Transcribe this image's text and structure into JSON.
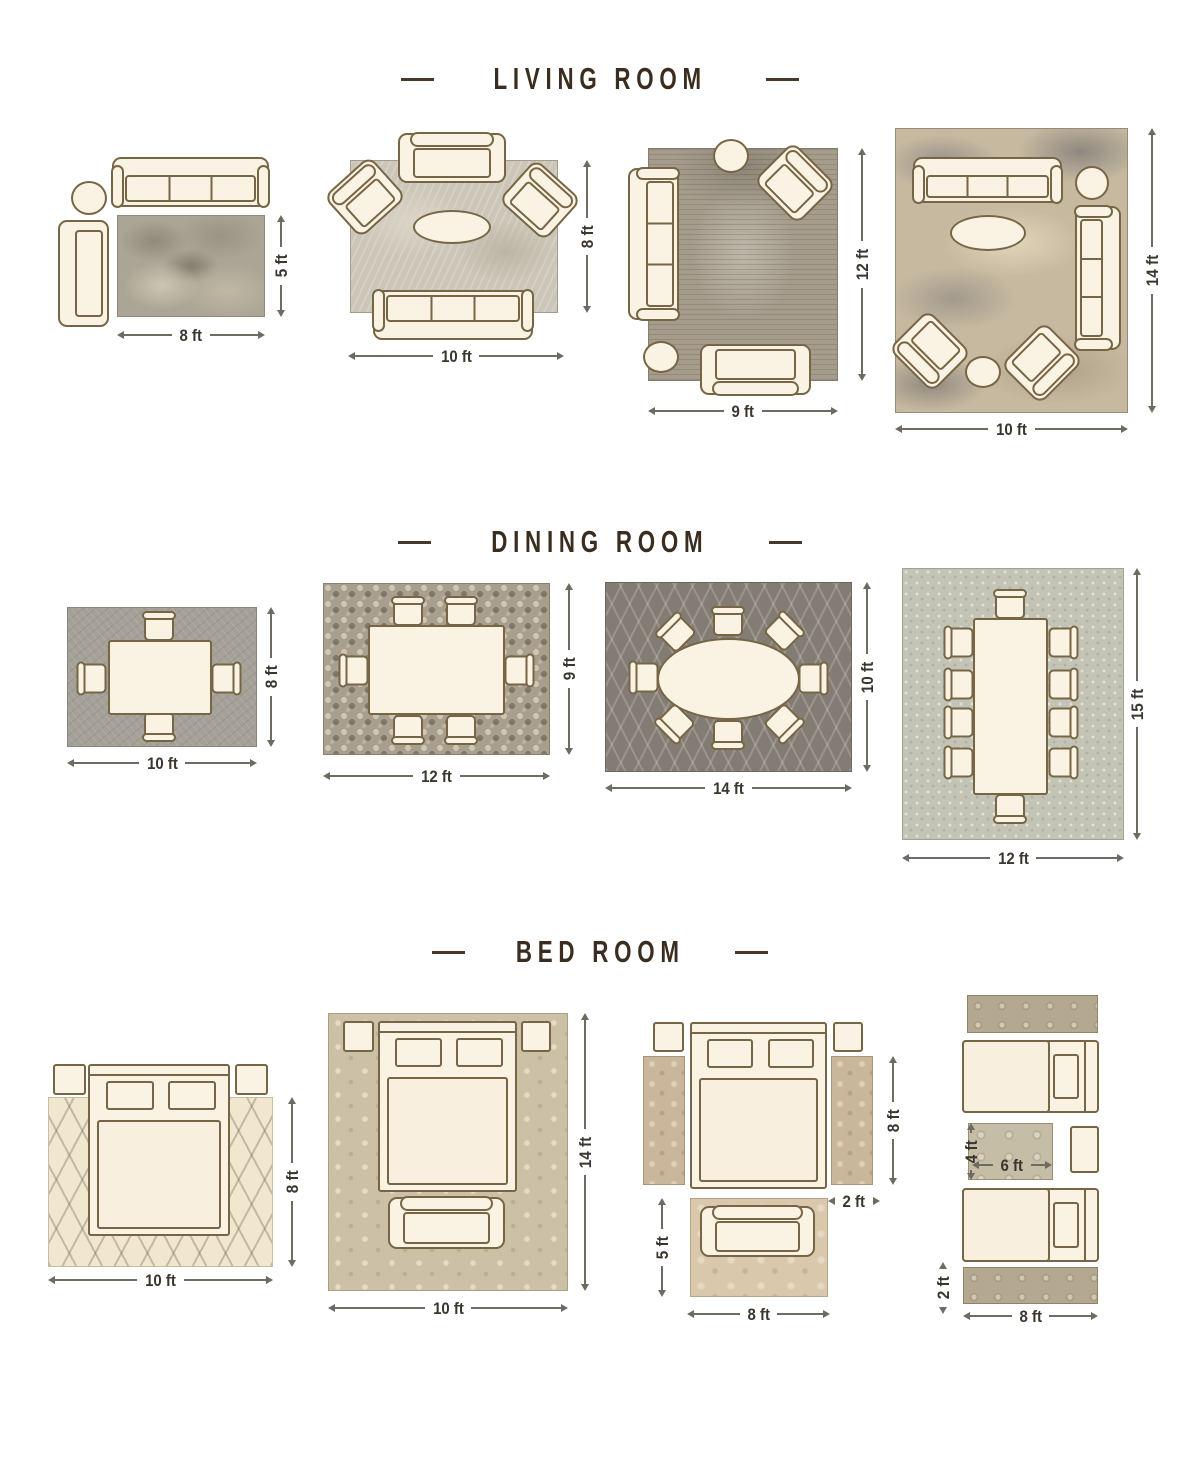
{
  "page": {
    "background": "#ffffff"
  },
  "colors": {
    "furniture_fill": "#faf2e3",
    "furniture_outline": "#776645",
    "title_text": "#3a2d1f",
    "title_dash": "#473829",
    "dimension_text": "#3a362e",
    "dimension_line": "#6f6b62"
  },
  "sections": [
    {
      "title": "LIVING ROOM",
      "layouts": [
        {
          "name": "living-rug-8x5",
          "rug_size": "8 ft x 5 ft",
          "furniture": [
            "sofa",
            "round-side-table",
            "chaise-sofa",
            "rug"
          ],
          "dims": {
            "bottom": "8 ft",
            "right": "5 ft"
          }
        },
        {
          "name": "living-rug-10x8",
          "rug_size": "10 ft x 8 ft",
          "furniture": [
            "loveseat",
            "armchair",
            "armchair",
            "oval-coffee-table",
            "sofa",
            "rug"
          ],
          "dims": {
            "bottom": "10 ft",
            "right": "8 ft"
          }
        },
        {
          "name": "living-rug-9x12",
          "rug_size": "9 ft x 12 ft",
          "furniture": [
            "round-side-table",
            "armchair",
            "sofa",
            "round-side-table",
            "loveseat",
            "rug"
          ],
          "dims": {
            "bottom": "9 ft",
            "right": "12 ft"
          }
        },
        {
          "name": "living-rug-10x14",
          "rug_size": "10 ft x 14 ft",
          "furniture": [
            "sofa",
            "round-side-table",
            "sofa",
            "oval-coffee-table",
            "armchair",
            "armchair",
            "round-side-table",
            "rug"
          ],
          "dims": {
            "bottom": "10 ft",
            "right": "14 ft"
          }
        }
      ]
    },
    {
      "title": "DINING ROOM",
      "layouts": [
        {
          "name": "dining-rug-10x8",
          "rug_size": "10 ft x 8 ft",
          "furniture": [
            "dining-table",
            "4 dining-chairs",
            "rug"
          ],
          "dims": {
            "bottom": "10 ft",
            "right": "8 ft"
          }
        },
        {
          "name": "dining-rug-12x9",
          "rug_size": "12 ft x 9 ft",
          "furniture": [
            "dining-table",
            "6 dining-chairs",
            "rug"
          ],
          "dims": {
            "bottom": "12 ft",
            "right": "9 ft"
          }
        },
        {
          "name": "dining-rug-14x10",
          "rug_size": "14 ft x 10 ft",
          "furniture": [
            "oval-dining-table",
            "8 dining-chairs",
            "rug"
          ],
          "dims": {
            "bottom": "14 ft",
            "right": "10 ft"
          }
        },
        {
          "name": "dining-rug-12x15",
          "rug_size": "12 ft x 15 ft",
          "furniture": [
            "dining-table",
            "10 dining-chairs",
            "rug"
          ],
          "dims": {
            "bottom": "12 ft",
            "right": "15 ft"
          }
        }
      ]
    },
    {
      "title": "BED ROOM",
      "layouts": [
        {
          "name": "bed-rug-10x8",
          "rug_size": "10 ft x 8 ft",
          "furniture": [
            "nightstand",
            "nightstand",
            "bed",
            "rug"
          ],
          "dims": {
            "bottom": "10 ft",
            "right": "8 ft"
          }
        },
        {
          "name": "bed-rug-10x14",
          "rug_size": "10 ft x 14 ft",
          "furniture": [
            "nightstand",
            "nightstand",
            "bed",
            "bench",
            "rug"
          ],
          "dims": {
            "bottom": "10 ft",
            "right": "14 ft"
          }
        },
        {
          "name": "bed-runners-and-foot-rug",
          "rug_size": "2 ft x 8 ft runners + 8 ft x 5 ft rug",
          "furniture": [
            "nightstand",
            "nightstand",
            "bed",
            "runner-rug",
            "runner-rug",
            "bench",
            "foot-rug"
          ],
          "dims": {
            "runner_length": "8 ft",
            "runner_width": "2 ft",
            "foot_rug_height": "5 ft",
            "foot_rug_width": "8 ft"
          }
        },
        {
          "name": "twin-beds-runners",
          "rug_size": "6 ft x 4 ft rug + 2 ft x 8 ft runners",
          "furniture": [
            "runner-rug",
            "twin-bed",
            "center-rug",
            "nightstand",
            "twin-bed",
            "runner-rug"
          ],
          "dims": {
            "rug_height": "4 ft",
            "rug_width": "6 ft",
            "runner_width": "2 ft",
            "runner_length": "8 ft"
          }
        }
      ]
    }
  ]
}
